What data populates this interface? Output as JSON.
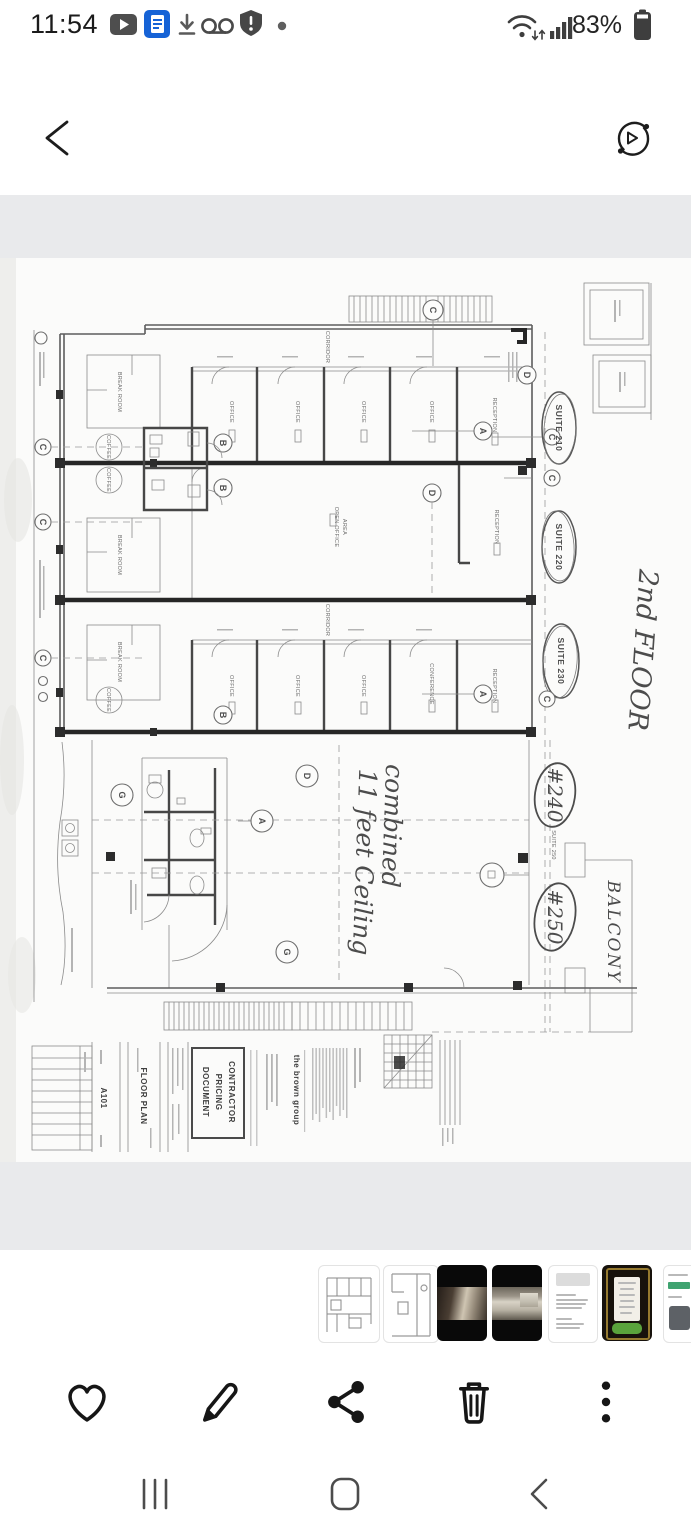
{
  "status_bar": {
    "time": "11:54",
    "battery_percent": "83%",
    "left_icons": [
      "play-badge-icon",
      "document-badge-icon",
      "download-icon",
      "voicemail-icon",
      "shield-alert-icon",
      "notification-dot-icon"
    ],
    "right_icons": [
      "wifi-icon",
      "signal-icon",
      "battery-icon"
    ]
  },
  "top_bar": {
    "back": "back",
    "motion_view": "motion-photo"
  },
  "floor_plan": {
    "suite_210": "SUITE 210",
    "suite_220": "SUITE 220",
    "suite_230": "SUITE 230",
    "suite_250": "SUITE 250",
    "hand_floor": "2nd FLOOR",
    "hand_combined_1": "combined",
    "hand_combined_2": "11 feet Ceiling",
    "hand_240": "#240",
    "hand_250": "#250",
    "hand_balcony": "BALCONY",
    "rooms": {
      "office": "OFFICE",
      "reception": "RECEPTION",
      "corridor": "CORRIDOR",
      "break_room": "BREAK ROOM",
      "coffee": "COFFEE",
      "conference": "CONFERENCE",
      "open_office": "OPEN OFFICE",
      "area": "AREA"
    },
    "bubbles": {
      "a": "A",
      "b": "B",
      "c": "C",
      "d": "D",
      "g": "G"
    },
    "title_block": {
      "sheet_no": "A101",
      "sheet_title": "FLOOR PLAN",
      "stamp_1": "CONTRACTOR",
      "stamp_2": "PRICING",
      "stamp_3": "DOCUMENT",
      "firm": "the brown group"
    }
  },
  "thumbnails": [
    {
      "label": "floor-plan-sketch"
    },
    {
      "label": "floor-plan-detail"
    },
    {
      "label": "hallway-photo"
    },
    {
      "label": "office-interior-photo"
    },
    {
      "label": "listing-text-card"
    },
    {
      "label": "menu-sign-photo"
    },
    {
      "label": "listing-text-card-2"
    }
  ],
  "action_bar": [
    "favorite",
    "edit",
    "share",
    "delete",
    "more"
  ],
  "nav_bar": [
    "recents",
    "home",
    "back"
  ]
}
